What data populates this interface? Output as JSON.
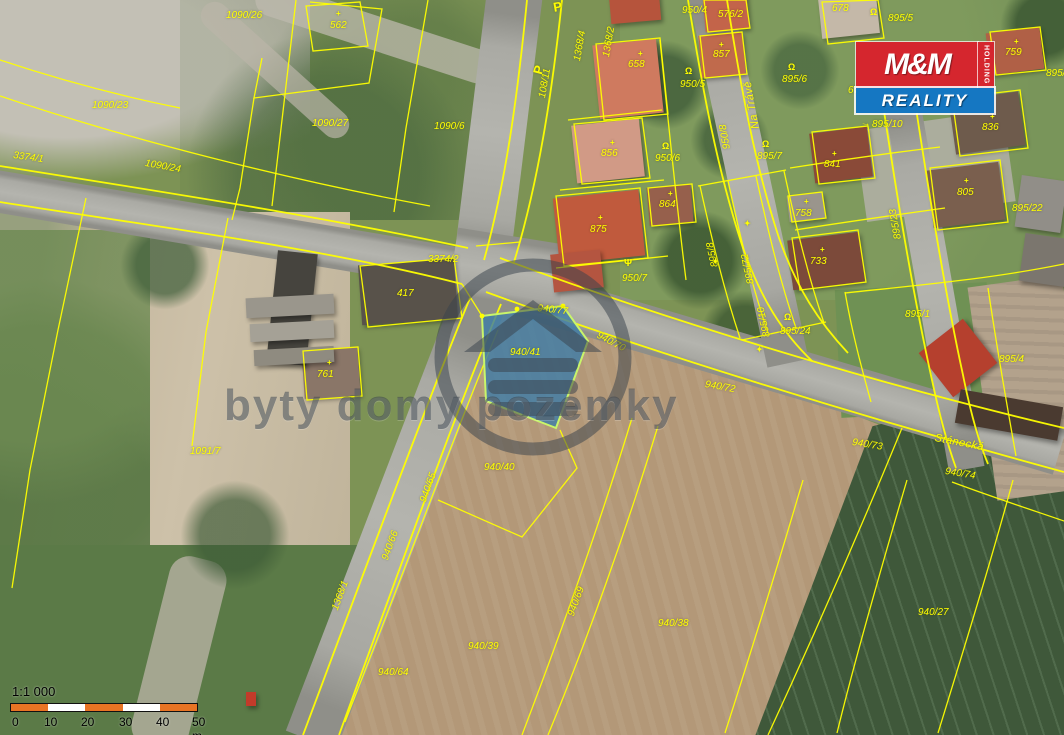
{
  "colors": {
    "line": "#ffff00",
    "label": "#ffff00",
    "highlight_fill": "#3c7ca8",
    "highlight_edge": "#c9f56a",
    "logo_red": "#d5262e",
    "logo_blue": "#1577c2",
    "scale_orange": "#e87424",
    "watermark": "rgba(58,68,76,0.52)"
  },
  "watermark": {
    "text": "byty domy pozemky"
  },
  "logo": {
    "mm": "M&M",
    "holding": "HOLDING",
    "reality": "REALITY"
  },
  "scale": {
    "ratio": "1:1 000",
    "ticks": [
      {
        "t": "0",
        "x": 4
      },
      {
        "t": "10",
        "x": 36
      },
      {
        "t": "20",
        "x": 73
      },
      {
        "t": "30",
        "x": 111
      },
      {
        "t": "40",
        "x": 148
      },
      {
        "t": "50 m",
        "x": 184
      }
    ]
  },
  "highlight": {
    "parcel": "940/41"
  },
  "streets": [
    {
      "t": "Na Trávě",
      "x": 750,
      "y": 130,
      "r": -100
    },
    {
      "t": "Stánecká",
      "x": 936,
      "y": 432,
      "r": 11
    }
  ],
  "parcels": [
    {
      "t": "1090/26",
      "x": 226,
      "y": 10,
      "r": 0
    },
    {
      "t": "562",
      "x": 330,
      "y": 20,
      "r": 0
    },
    {
      "t": "1090/23",
      "x": 92,
      "y": 100,
      "r": 0
    },
    {
      "t": "1090/27",
      "x": 312,
      "y": 118,
      "r": 0
    },
    {
      "t": "1090/6",
      "x": 434,
      "y": 121,
      "r": 0
    },
    {
      "t": "3374/1",
      "x": 14,
      "y": 150,
      "r": 8
    },
    {
      "t": "1090/24",
      "x": 146,
      "y": 158,
      "r": 10
    },
    {
      "t": "108/11",
      "x": 537,
      "y": 97,
      "r": -80
    },
    {
      "t": "1368/4",
      "x": 572,
      "y": 60,
      "r": -80
    },
    {
      "t": "1368/2",
      "x": 601,
      "y": 56,
      "r": -80
    },
    {
      "t": "658",
      "x": 628,
      "y": 59,
      "r": 0
    },
    {
      "t": "950/4",
      "x": 682,
      "y": 5,
      "r": 0
    },
    {
      "t": "576/2",
      "x": 718,
      "y": 9,
      "r": 0
    },
    {
      "t": "857",
      "x": 713,
      "y": 49,
      "r": 0
    },
    {
      "t": "950/5",
      "x": 680,
      "y": 79,
      "r": 0
    },
    {
      "t": "950/8",
      "x": 722,
      "y": 150,
      "r": -100
    },
    {
      "t": "856",
      "x": 601,
      "y": 148,
      "r": 0
    },
    {
      "t": "950/6",
      "x": 655,
      "y": 153,
      "r": 0
    },
    {
      "t": "864",
      "x": 659,
      "y": 199,
      "r": 0
    },
    {
      "t": "875",
      "x": 590,
      "y": 224,
      "r": 0
    },
    {
      "t": "950/7",
      "x": 622,
      "y": 273,
      "r": 0
    },
    {
      "t": "678",
      "x": 832,
      "y": 3,
      "r": 0
    },
    {
      "t": "895/5",
      "x": 888,
      "y": 13,
      "r": 0
    },
    {
      "t": "679",
      "x": 848,
      "y": 85,
      "r": 0
    },
    {
      "t": "895/6",
      "x": 782,
      "y": 74,
      "r": 0
    },
    {
      "t": "895/7",
      "x": 757,
      "y": 151,
      "r": 0
    },
    {
      "t": "841",
      "x": 824,
      "y": 159,
      "r": 0
    },
    {
      "t": "758",
      "x": 795,
      "y": 208,
      "r": 0
    },
    {
      "t": "733",
      "x": 810,
      "y": 256,
      "r": 0
    },
    {
      "t": "759",
      "x": 1005,
      "y": 47,
      "r": 0
    },
    {
      "t": "895/1",
      "x": 1046,
      "y": 68,
      "r": 0
    },
    {
      "t": "805",
      "x": 957,
      "y": 187,
      "r": 0
    },
    {
      "t": "836",
      "x": 982,
      "y": 122,
      "r": 0
    },
    {
      "t": "895/22",
      "x": 1012,
      "y": 203,
      "r": 0
    },
    {
      "t": "895/10",
      "x": 872,
      "y": 119,
      "r": 0
    },
    {
      "t": "895/23",
      "x": 893,
      "y": 240,
      "r": -100
    },
    {
      "t": "895/8",
      "x": 710,
      "y": 268,
      "r": -102
    },
    {
      "t": "895/72",
      "x": 746,
      "y": 285,
      "r": -102
    },
    {
      "t": "895/10",
      "x": 762,
      "y": 338,
      "r": -102
    },
    {
      "t": "895/24",
      "x": 780,
      "y": 326,
      "r": 0
    },
    {
      "t": "895/1",
      "x": 905,
      "y": 309,
      "r": 0
    },
    {
      "t": "895/4",
      "x": 999,
      "y": 354,
      "r": 0
    },
    {
      "t": "3374/2",
      "x": 428,
      "y": 254,
      "r": 0
    },
    {
      "t": "417",
      "x": 397,
      "y": 288,
      "r": 0
    },
    {
      "t": "761",
      "x": 317,
      "y": 369,
      "r": 0
    },
    {
      "t": "1091/7",
      "x": 190,
      "y": 446,
      "r": 0
    },
    {
      "t": "940/77",
      "x": 538,
      "y": 303,
      "r": 6
    },
    {
      "t": "940/41",
      "x": 510,
      "y": 347,
      "r": 0
    },
    {
      "t": "940/70",
      "x": 600,
      "y": 330,
      "r": 28
    },
    {
      "t": "940/72",
      "x": 706,
      "y": 379,
      "r": 10
    },
    {
      "t": "940/73",
      "x": 853,
      "y": 437,
      "r": 9
    },
    {
      "t": "940/74",
      "x": 946,
      "y": 466,
      "r": 9
    },
    {
      "t": "940/40",
      "x": 484,
      "y": 462,
      "r": 0
    },
    {
      "t": "940/65",
      "x": 418,
      "y": 500,
      "r": -70
    },
    {
      "t": "940/66",
      "x": 380,
      "y": 558,
      "r": -70
    },
    {
      "t": "1368/1",
      "x": 330,
      "y": 608,
      "r": -70
    },
    {
      "t": "940/69",
      "x": 566,
      "y": 614,
      "r": -70
    },
    {
      "t": "940/38",
      "x": 658,
      "y": 618,
      "r": 0
    },
    {
      "t": "940/39",
      "x": 468,
      "y": 641,
      "r": 0
    },
    {
      "t": "940/64",
      "x": 378,
      "y": 667,
      "r": 0
    },
    {
      "t": "940/27",
      "x": 918,
      "y": 607,
      "r": 0
    }
  ],
  "symbols": [
    {
      "g": "Ω",
      "x": 685,
      "y": 66,
      "r": 0,
      "s": 9,
      "n": "well-icon"
    },
    {
      "g": "Ω",
      "x": 662,
      "y": 141,
      "r": 0,
      "s": 9,
      "n": "well-icon"
    },
    {
      "g": "Ω",
      "x": 788,
      "y": 62,
      "r": 0,
      "s": 9,
      "n": "well-icon"
    },
    {
      "g": "Ω",
      "x": 762,
      "y": 139,
      "r": 0,
      "s": 9,
      "n": "well-icon"
    },
    {
      "g": "Ω",
      "x": 784,
      "y": 312,
      "r": 0,
      "s": 9,
      "n": "well-icon"
    },
    {
      "g": "Ω",
      "x": 870,
      "y": 7,
      "r": 0,
      "s": 9,
      "n": "well-icon"
    },
    {
      "g": "+",
      "x": 719,
      "y": 40,
      "r": 0,
      "s": 8,
      "n": "building-cross-icon"
    },
    {
      "g": "+",
      "x": 638,
      "y": 49,
      "r": 0,
      "s": 8,
      "n": "building-cross-icon"
    },
    {
      "g": "+",
      "x": 610,
      "y": 138,
      "r": 0,
      "s": 8,
      "n": "building-cross-icon"
    },
    {
      "g": "+",
      "x": 668,
      "y": 189,
      "r": 0,
      "s": 8,
      "n": "building-cross-icon"
    },
    {
      "g": "+",
      "x": 598,
      "y": 213,
      "r": 0,
      "s": 8,
      "n": "building-cross-icon"
    },
    {
      "g": "+",
      "x": 832,
      "y": 149,
      "r": 0,
      "s": 8,
      "n": "building-cross-icon"
    },
    {
      "g": "+",
      "x": 804,
      "y": 197,
      "r": 0,
      "s": 8,
      "n": "building-cross-icon"
    },
    {
      "g": "+",
      "x": 820,
      "y": 245,
      "r": 0,
      "s": 8,
      "n": "building-cross-icon"
    },
    {
      "g": "+",
      "x": 990,
      "y": 112,
      "r": 0,
      "s": 8,
      "n": "building-cross-icon"
    },
    {
      "g": "+",
      "x": 964,
      "y": 176,
      "r": 0,
      "s": 8,
      "n": "building-cross-icon"
    },
    {
      "g": "+",
      "x": 1014,
      "y": 37,
      "r": 0,
      "s": 8,
      "n": "building-cross-icon"
    },
    {
      "g": "+",
      "x": 327,
      "y": 358,
      "r": 0,
      "s": 8,
      "n": "building-cross-icon"
    },
    {
      "g": "+",
      "x": 336,
      "y": 9,
      "r": 0,
      "s": 8,
      "n": "building-cross-icon"
    },
    {
      "g": "✦",
      "x": 744,
      "y": 219,
      "r": 0,
      "s": 8,
      "n": "boundary-mark-icon"
    },
    {
      "g": "✦",
      "x": 712,
      "y": 257,
      "r": 0,
      "s": 8,
      "n": "boundary-mark-icon"
    },
    {
      "g": "✦",
      "x": 756,
      "y": 345,
      "r": 0,
      "s": 8,
      "n": "boundary-mark-icon"
    },
    {
      "g": "Ψ",
      "x": 624,
      "y": 258,
      "r": 0,
      "s": 10,
      "n": "tree-icon"
    },
    {
      "g": "P",
      "x": 552,
      "y": 0,
      "r": -10,
      "s": 13,
      "n": "parking-icon"
    },
    {
      "g": "P",
      "x": 530,
      "y": 72,
      "r": -75,
      "s": 13,
      "n": "parking-icon"
    },
    {
      "g": "→",
      "x": 862,
      "y": 117,
      "r": 12,
      "s": 10,
      "n": "direction-arrow-icon"
    }
  ]
}
